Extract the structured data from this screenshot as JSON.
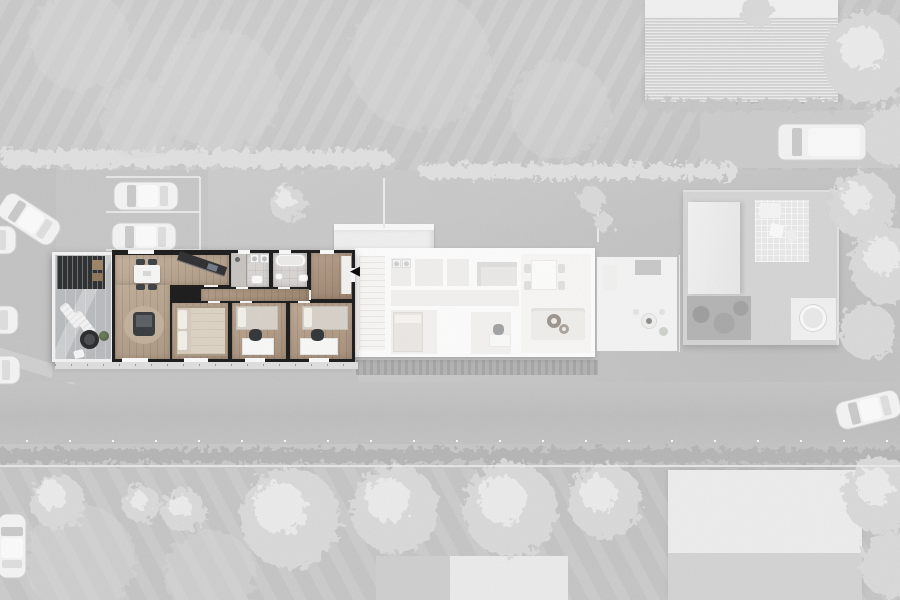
{
  "icons": {
    "entrance_arrow": "◀"
  },
  "colors": {
    "ground": "#c8c8c8",
    "road": "#bfbfbf",
    "hedge_light": "#e0e0e0",
    "hedge_dark": "#b4b4b4",
    "tree": "#d9d9d9",
    "tree_highlight": "#efefef",
    "roof_mid": "#d9d9d9",
    "roof_light": "#ededed",
    "car_body": "#f4f4f4",
    "car_glass": "#c9c9c9",
    "unit_wall": "#151515",
    "wood_living": "#bda78f",
    "wood_hall": "#aa9078",
    "wood_bedroom": "#b59c84",
    "tile_bath": "#d7d4d1",
    "terrace_paving": "#b7babc",
    "pergola": "#26282a",
    "neighbor_bg": "#fdfdfd",
    "neighbor_floor": "#f4f2f0",
    "neighbor_living": "#f8f7f5",
    "plant": "#5e7150",
    "arrow": "#000000"
  }
}
